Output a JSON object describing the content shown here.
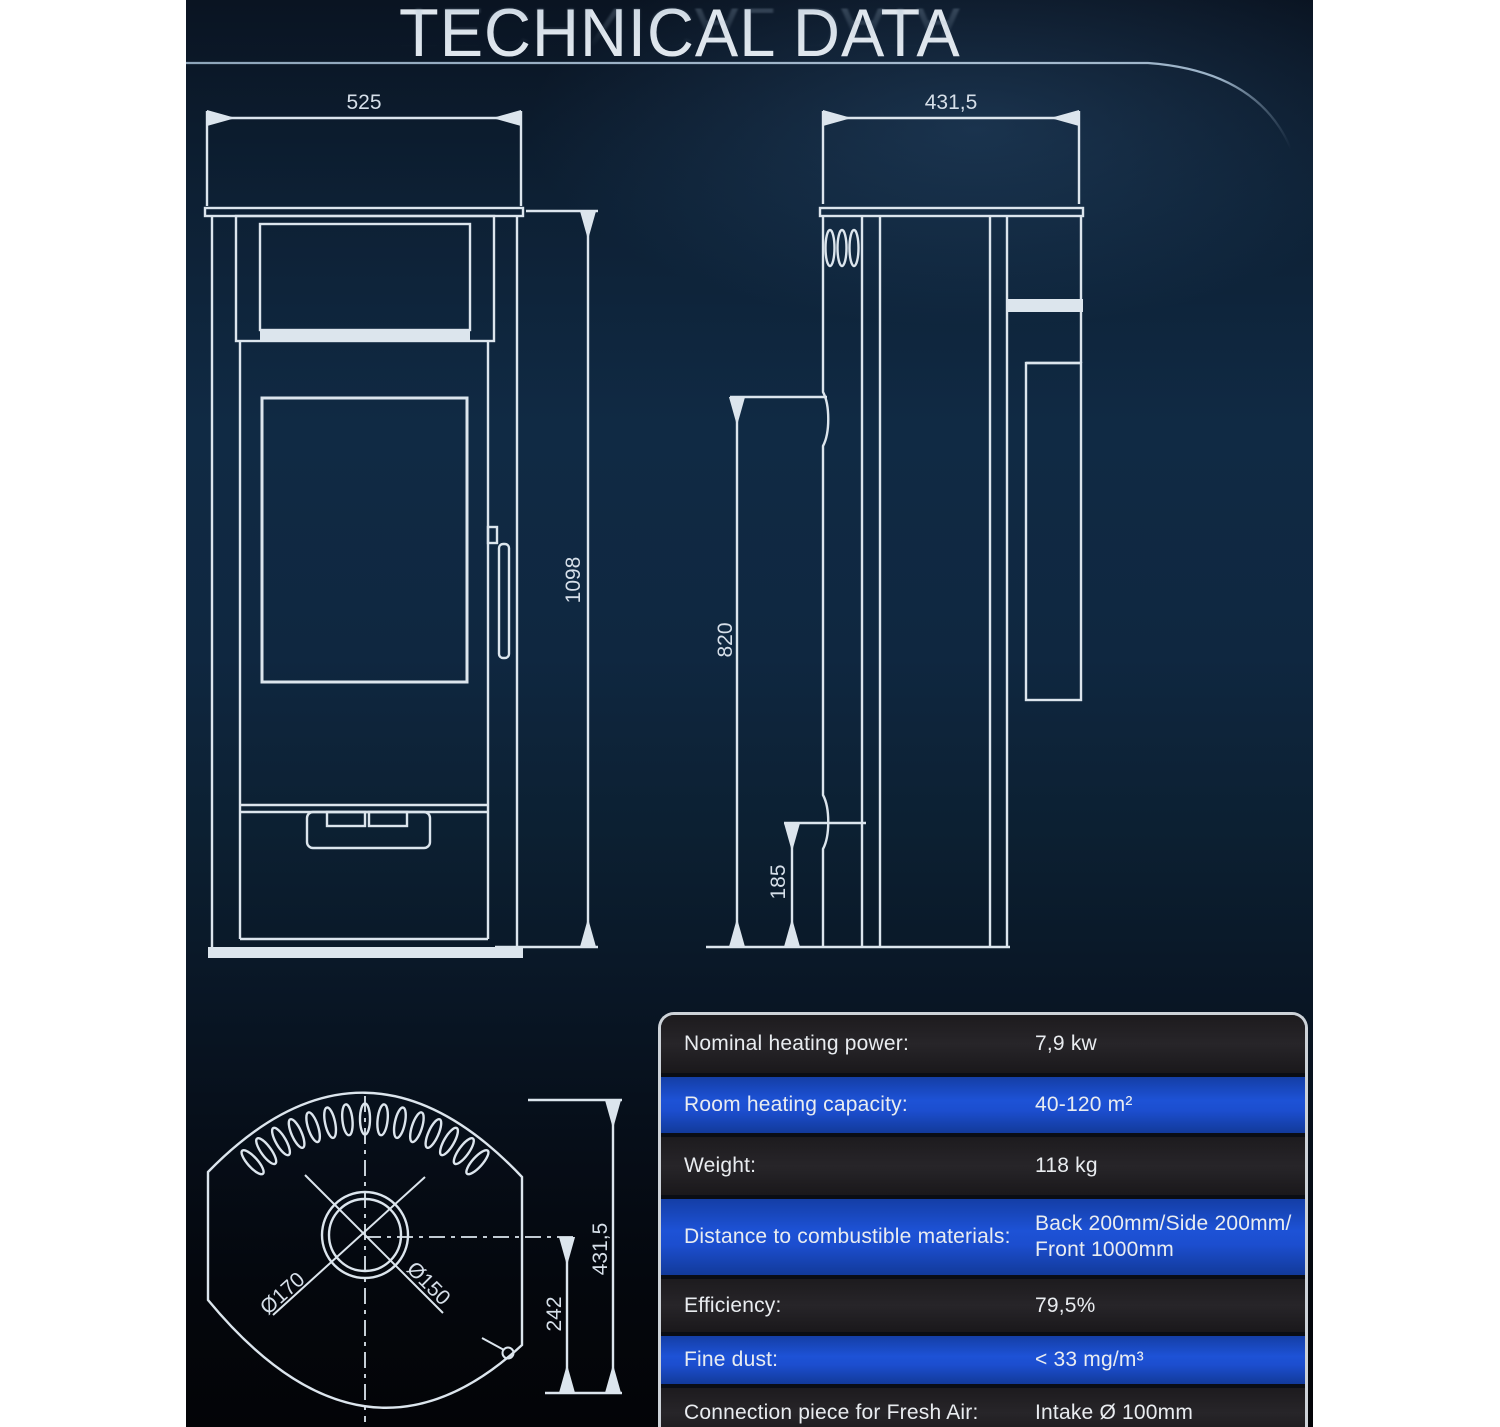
{
  "header": {
    "title": "TECHNICAL DATA"
  },
  "views": {
    "front": {
      "width_label": "525",
      "height_label": "1098"
    },
    "side": {
      "depth_label": "431,5",
      "upper_height_label": "820",
      "lower_height_label": "185"
    },
    "top": {
      "outer_diameter_label": "Ø170",
      "inner_diameter_label": "Ø150",
      "center_offset_label": "242",
      "depth_label": "431,5"
    }
  },
  "spec_table": {
    "rows": [
      {
        "label": "Nominal heating power:",
        "value": "7,9 kw"
      },
      {
        "label": "Room heating capacity:",
        "value": "40-120 m²"
      },
      {
        "label": "Weight:",
        "value": "118 kg"
      },
      {
        "label": "Distance to combustible materials:",
        "value": "Back 200mm/Side 200mm/",
        "value2": "Front 1000mm"
      },
      {
        "label": "Efficiency:",
        "value": "79,5%"
      },
      {
        "label": "Fine dust:",
        "value": "< 33 mg/m³"
      },
      {
        "label": "Connection piece for Fresh Air:",
        "value": "Intake Ø 100mm"
      }
    ]
  },
  "colors": {
    "accent_blue": "#1d52d6",
    "row_dark": "#1d1b1e",
    "drawing_line": "#dce5ed",
    "background_navy": "#0f2740",
    "table_border": "#cdd2d8",
    "page_margin": "#ffffff"
  }
}
